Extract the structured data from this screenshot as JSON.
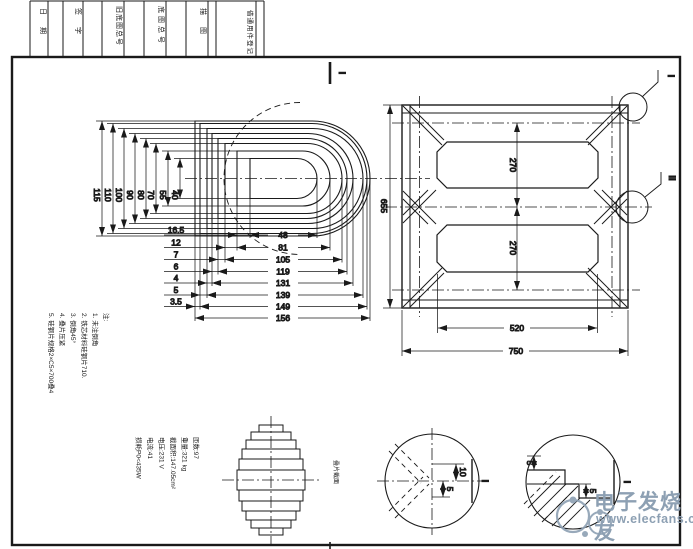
{
  "title_block": {
    "cells": [
      "日期",
      "签字",
      "旧底图总号",
      "底图总号",
      "描图"
    ],
    "register": "借通用件登记"
  },
  "coil": {
    "section_mark": "I",
    "heights": [
      "115",
      "110",
      "100",
      "90",
      "80",
      "70",
      "55",
      "40"
    ],
    "small_widths": [
      "16.5",
      "12",
      "7",
      "6",
      "4",
      "5",
      "3.5"
    ],
    "widths": [
      "48",
      "81",
      "105",
      "119",
      "131",
      "139",
      "149",
      "156"
    ]
  },
  "core": {
    "height": "655",
    "pitch": [
      "270",
      "270"
    ],
    "window_width": "520",
    "total_width": "750",
    "corner_mark": "I",
    "tee_mark": "II"
  },
  "stack": {
    "label": "叠片截面"
  },
  "detail1": {
    "dims": [
      "10",
      "5"
    ],
    "mark": "I"
  },
  "detail2": {
    "dims": [
      "5",
      "5"
    ],
    "mark": "I"
  },
  "notes": {
    "header": "注:",
    "items": [
      "1. 未注倒角",
      "2. 铁芯材料硅钢片710.",
      "3. 倒角45°",
      "4. 叠片压紧",
      "5. 硅钢片规格2×C5×700叠4"
    ]
  },
  "specs": [
    "匝数:97",
    "重量:321 kg",
    "截面积:147.05cm²",
    "电压:231 V",
    "电流:41",
    "损耗P0<435W"
  ],
  "watermark": {
    "brand": "电子发烧友",
    "site": "www.elecfans.com",
    "color": "#8da0b3"
  },
  "colors": {
    "line": "#1a1a1a",
    "watermark": "#8da0b3"
  }
}
